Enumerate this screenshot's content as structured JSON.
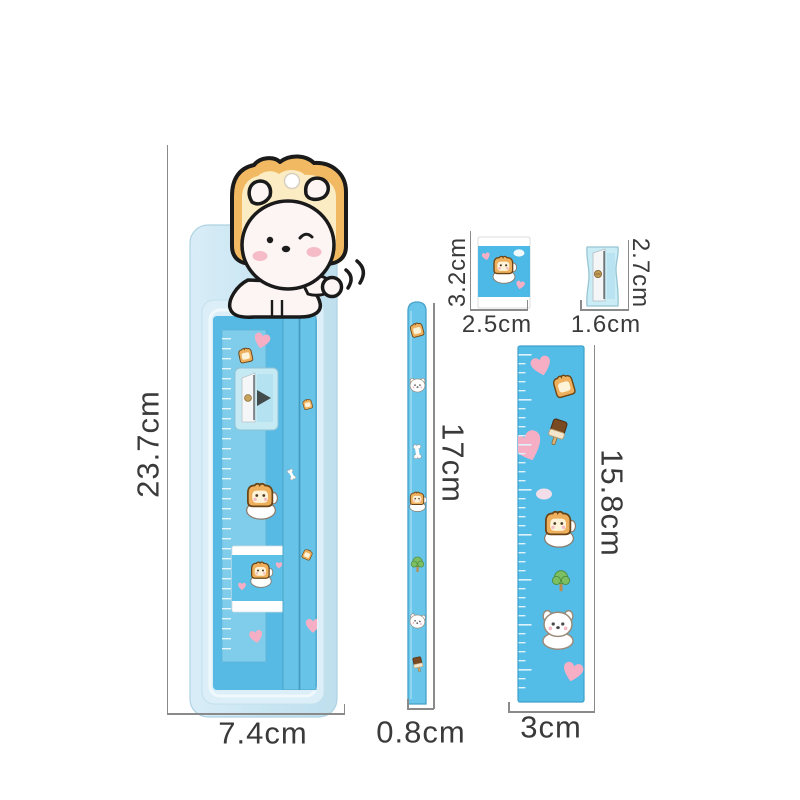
{
  "products": {
    "package": {
      "item": "stationery-set-blister-pack",
      "height": "23.7cm",
      "width": "7.4cm"
    },
    "eraser": {
      "item": "eraser",
      "height": "3.2cm",
      "width": "2.5cm"
    },
    "sharpener": {
      "item": "pencil-sharpener",
      "height": "2.7cm",
      "width": "1.6cm"
    },
    "pencil": {
      "item": "pencil",
      "height": "17cm",
      "width": "0.8cm"
    },
    "ruler": {
      "item": "ruler",
      "height": "15.8cm",
      "width": "3cm"
    }
  },
  "icons": [
    "toast-icon",
    "heart-icon",
    "toast-dog-icon",
    "tree-icon",
    "drink-icon",
    "bone-icon",
    "dog-face-icon",
    "puppy-icon",
    "hang-hole",
    "motion-lines-icon"
  ],
  "colors": {
    "background": "#ffffff",
    "blister_blue": "#cfe9f4",
    "product_blue": "#55bbe6",
    "pencil_blue": "#69c5e9",
    "toast_crust": "#eeb05c",
    "toast_inner": "#fdf3d8",
    "heart_pink": "#f6aec4",
    "blush_pink": "#f5bcc7",
    "leaf_green": "#7cbf63",
    "dimension_line_gray": "#8a8a8a",
    "label_text": "#3a3a3a"
  }
}
